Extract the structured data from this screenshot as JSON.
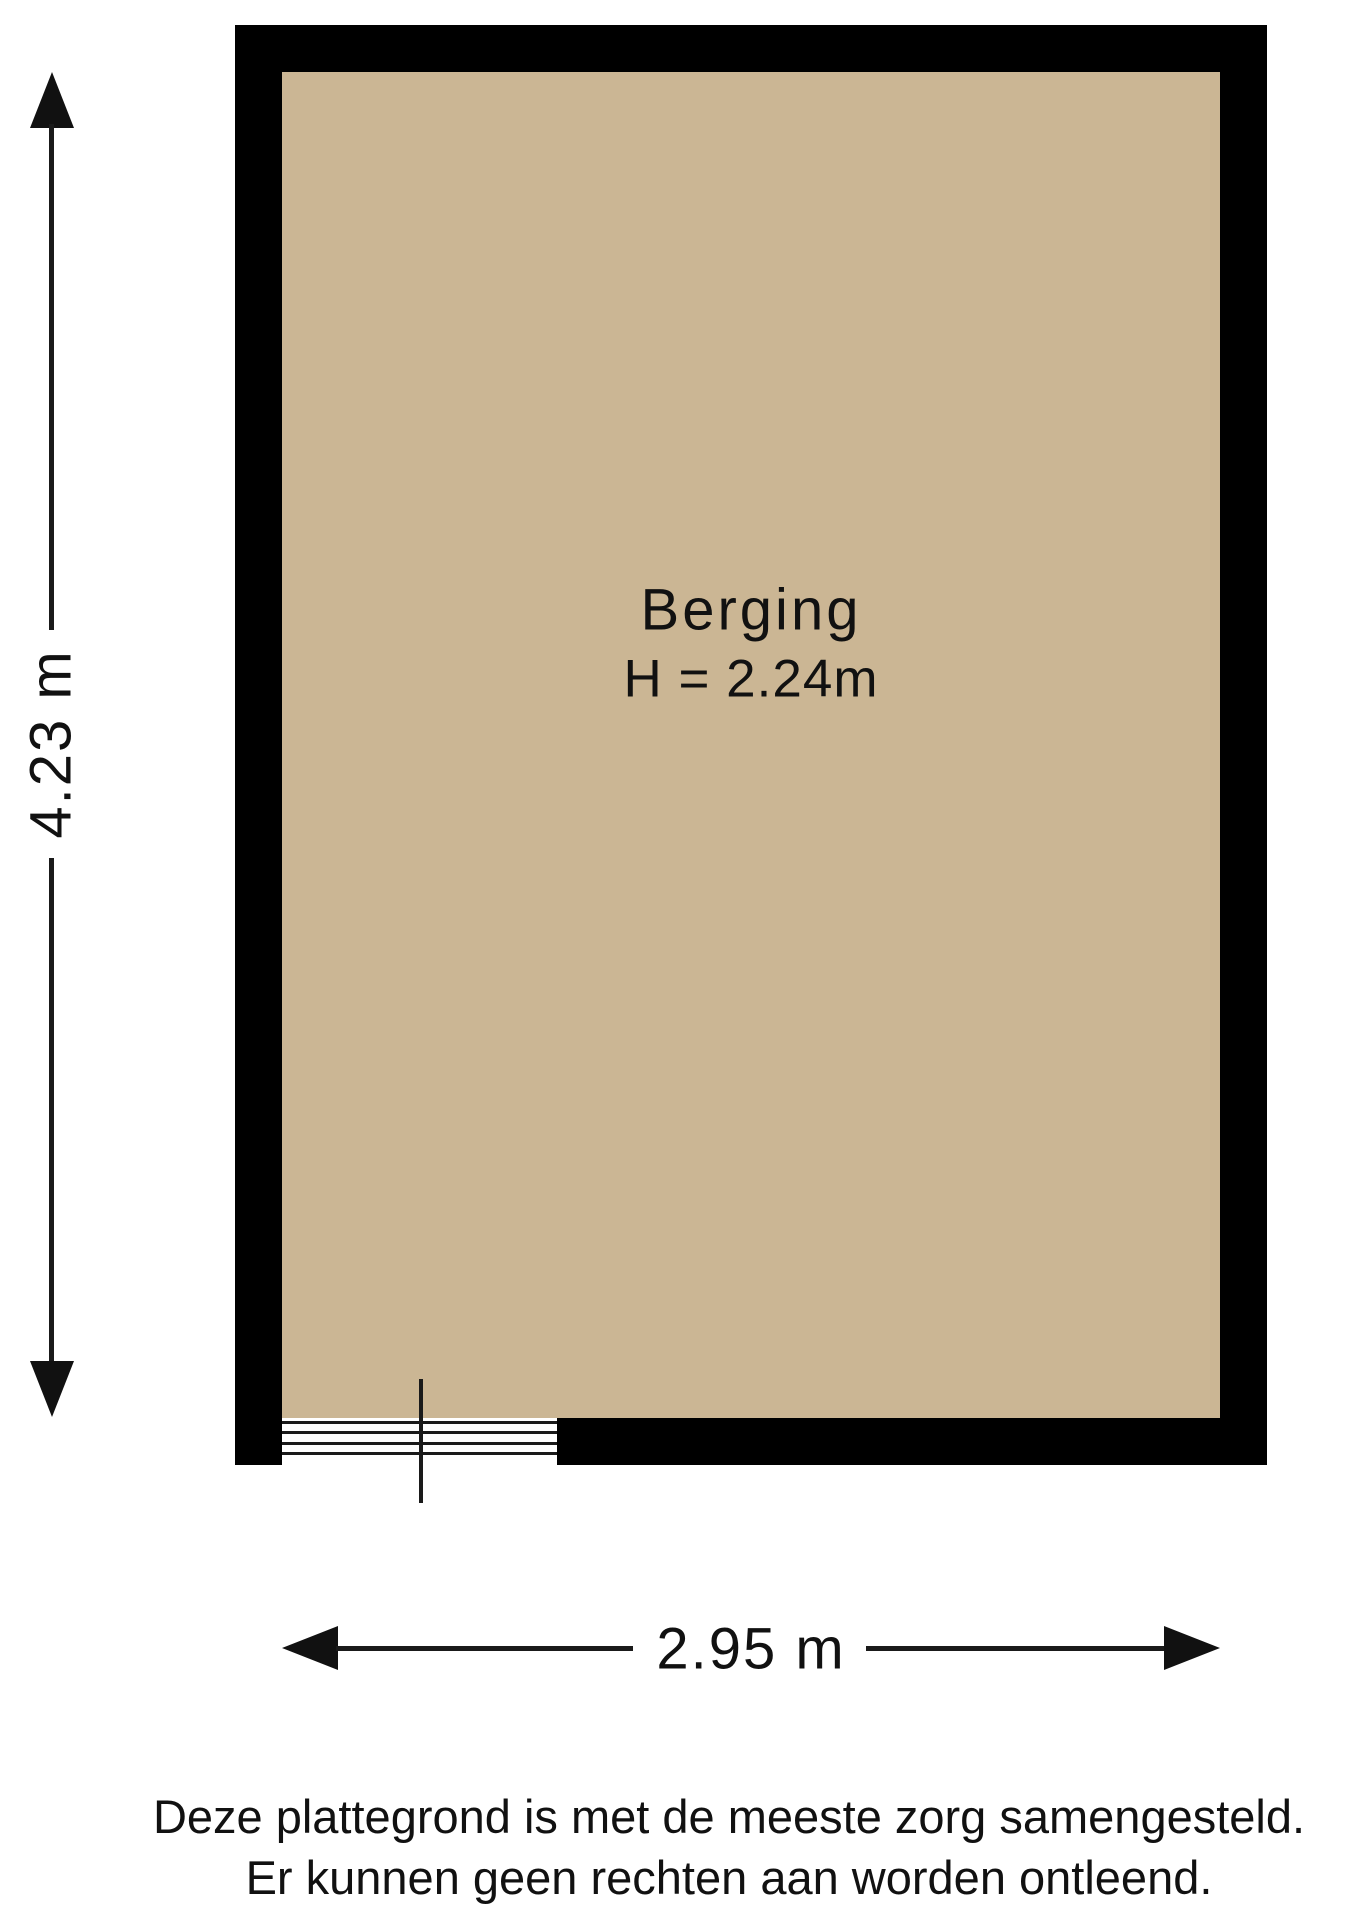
{
  "plan": {
    "room": {
      "name": "Berging",
      "height_label": "H = 2.24m"
    },
    "dimensions": {
      "width_label": "2.95 m",
      "height_label": "4.23 m"
    },
    "disclaimer": {
      "line1": "Deze plattegrond is met de meeste zorg samengesteld.",
      "line2": "Er kunnen geen rechten aan worden ontleend."
    },
    "colors": {
      "floor": "#cbb694",
      "wall": "#000000",
      "line": "#1a1a1a"
    }
  }
}
